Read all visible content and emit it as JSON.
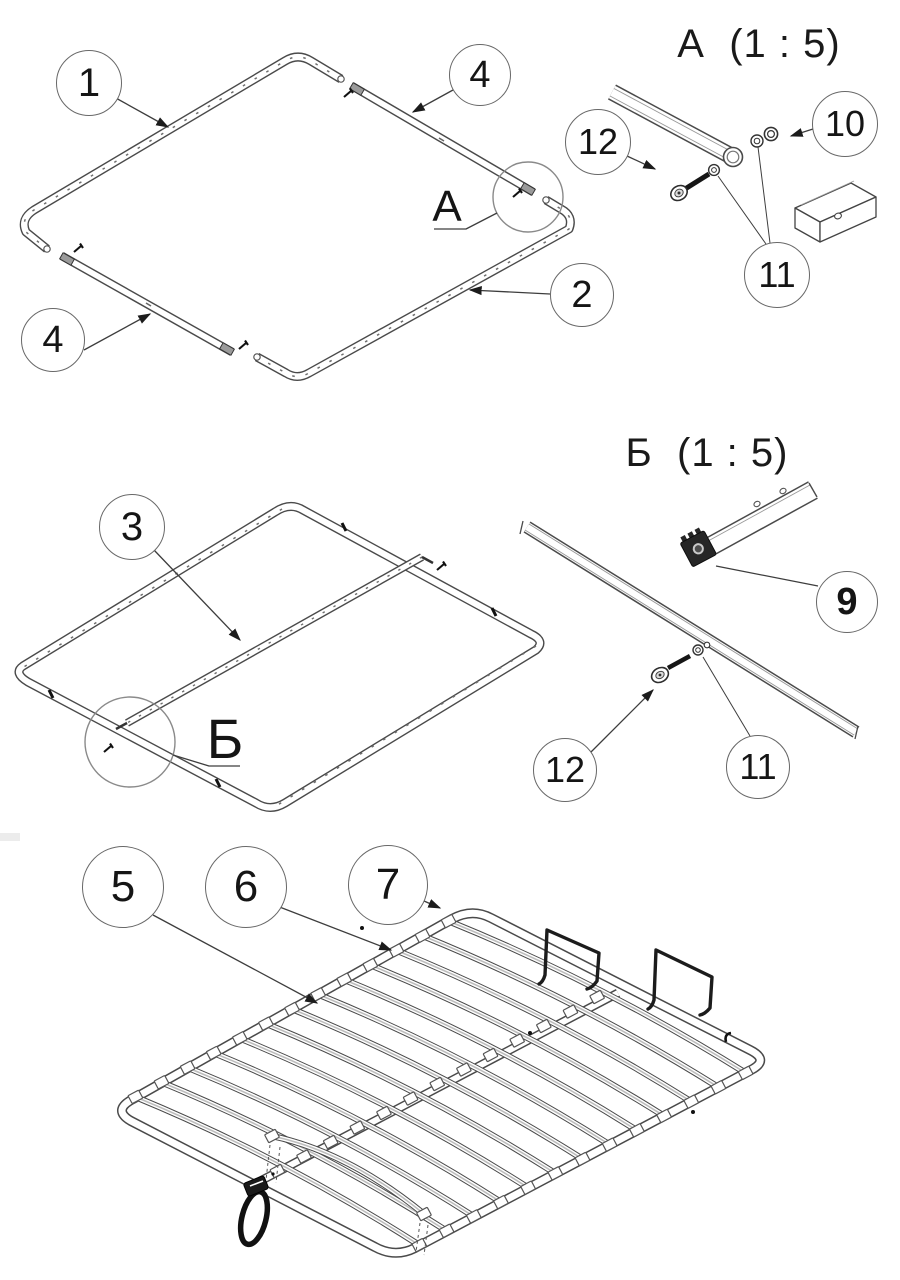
{
  "drawing": {
    "views": {
      "frame_exploded": {
        "detail_marker": "А",
        "callouts": [
          {
            "label": "1"
          },
          {
            "label": "4"
          },
          {
            "label": "2"
          },
          {
            "label": "4"
          }
        ]
      },
      "frame_assembled": {
        "detail_marker": "Б",
        "callouts": [
          {
            "label": "3"
          }
        ]
      },
      "slatted_base": {
        "callouts": [
          {
            "label": "5"
          },
          {
            "label": "6"
          },
          {
            "label": "7"
          }
        ]
      }
    },
    "details": {
      "a": {
        "title": "А  (1 : 5)",
        "callouts": [
          {
            "label": "12"
          },
          {
            "label": "10"
          },
          {
            "label": "11"
          }
        ]
      },
      "b": {
        "title": "Б  (1 : 5)",
        "callouts": [
          {
            "label": "9"
          },
          {
            "label": "12"
          },
          {
            "label": "11"
          }
        ]
      }
    },
    "colors": {
      "line": "#4a4a4a",
      "accent": "#1c1c1c",
      "background": "#ffffff"
    }
  }
}
